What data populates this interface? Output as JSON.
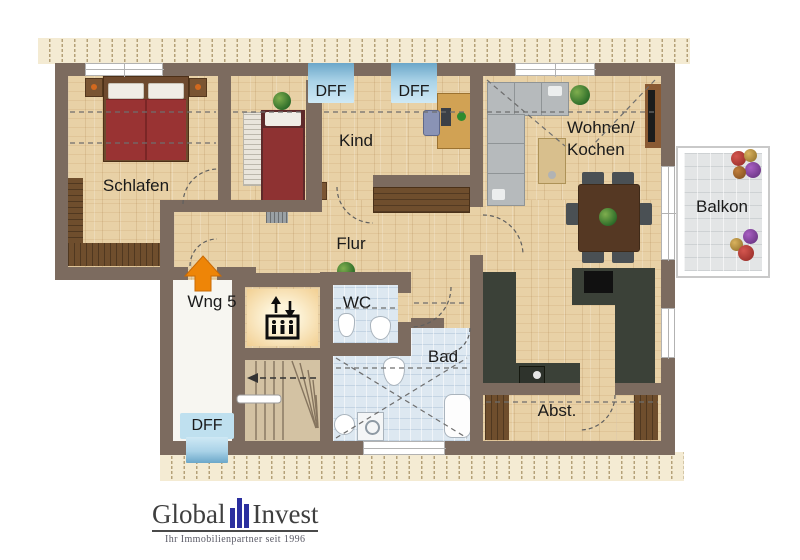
{
  "rooms": {
    "schlafen": {
      "label": "Schlafen"
    },
    "kind": {
      "label": "Kind"
    },
    "flur": {
      "label": "Flur"
    },
    "wohnen_kochen": {
      "line1": "Wohnen/",
      "line2": "Kochen"
    },
    "balkon": {
      "label": "Balkon"
    },
    "wng": {
      "label": "Wng 5"
    },
    "wc": {
      "label": "WC"
    },
    "bad": {
      "label": "Bad"
    },
    "abst": {
      "label": "Abst."
    }
  },
  "roof_windows": {
    "top_left": {
      "label": "DFF"
    },
    "top_right": {
      "label": "DFF"
    },
    "bottom": {
      "label": "DFF"
    }
  },
  "icons": {
    "elevator": "elevator-icon",
    "entrance_arrow": "entrance-arrow-icon"
  },
  "colors": {
    "wall": "#7c6b5f",
    "wood_floor": "#e8d1a6",
    "roof_window_blue": "#a9d2e7",
    "bath_tile": "#dde8f1",
    "entrance_arrow": "#ee8507",
    "bed_red": "#993333",
    "counter_dark": "#3b4138",
    "logo_blue": "#2b2f9f"
  },
  "logo": {
    "word1": "Global",
    "word2": "Invest",
    "tagline": "Ihr Immobilienpartner seit 1996"
  }
}
